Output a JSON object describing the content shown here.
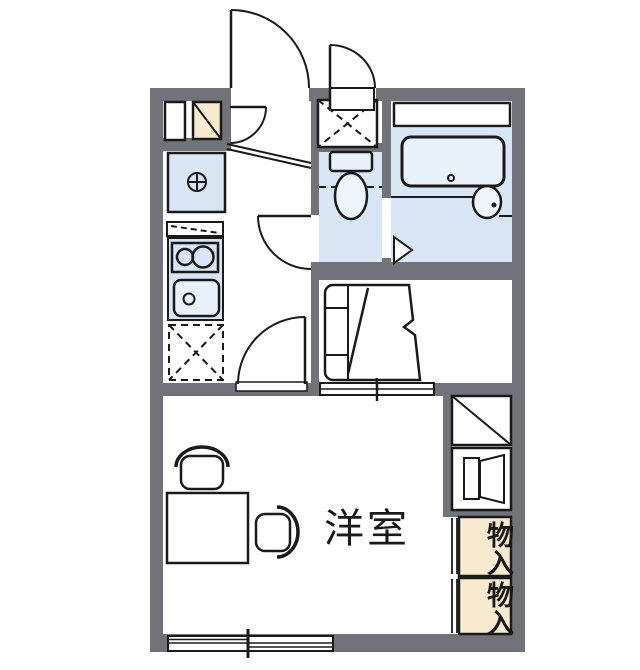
{
  "floorplan": {
    "labels": {
      "western_room": "洋室",
      "storage_upper": "物入",
      "storage_lower": "物入"
    },
    "colors": {
      "wall": "#72727b",
      "room_fill": "#d8e5f5",
      "fixture_fill": "#e9f1fb",
      "basin_fill": "#eef4fc",
      "storage_fill": "#f8eace",
      "line": "#1a1a1a",
      "background": "#ffffff"
    }
  }
}
